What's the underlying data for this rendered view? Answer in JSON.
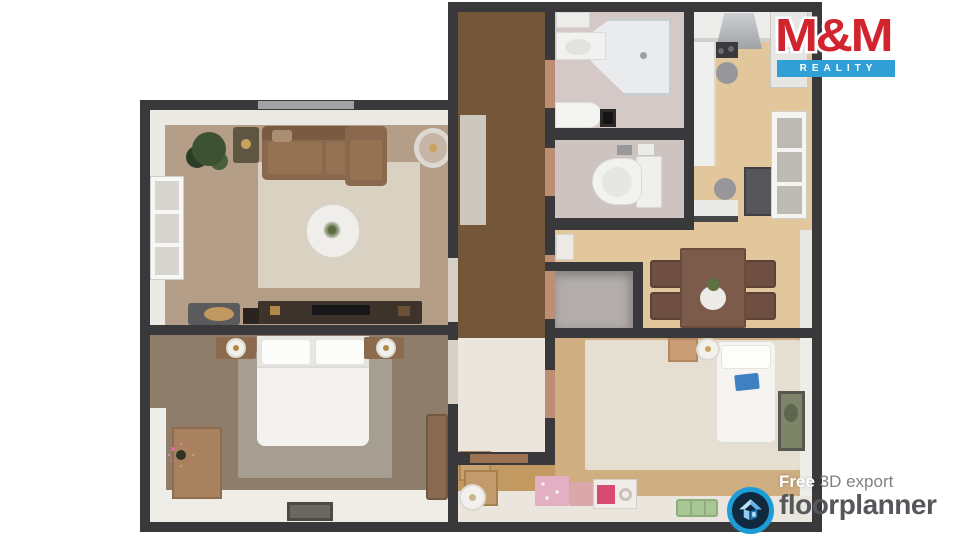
{
  "canvas": {
    "width": 960,
    "height": 540,
    "background": "#ffffff"
  },
  "branding": {
    "mm_reality": {
      "title": "M&M",
      "subtitle": "REALITY",
      "title_color": "#d2242e",
      "banner_color": "#2f9fd6",
      "subtitle_color": "#ffffff"
    }
  },
  "watermark": {
    "prefix_bold": "Free",
    "suffix": " 3D export",
    "brand": "floorplanner",
    "icon": "floorplanner-house-icon",
    "ring_color": "#1e9cd7",
    "badge_fill": "#10293e",
    "text_color": "#56575b"
  },
  "floorplan": {
    "type": "3d-top-down-apartment",
    "wall_color": "#39393b",
    "rooms": [
      {
        "name": "living-room",
        "floor_color": "#b59e87",
        "furniture": [
          "corner-sofa",
          "patterned-rug",
          "round-coffee-table",
          "tv-console",
          "potted-plant",
          "ceiling-fan",
          "side-table",
          "pet-bed",
          "left-window",
          "top-window"
        ]
      },
      {
        "name": "bedroom",
        "floor_color": "#8f7d6b",
        "furniture": [
          "double-bed",
          "nightstand-lamp-left",
          "nightstand-lamp-right",
          "gray-rug",
          "dresser-with-flowers",
          "storage-bench",
          "doormat"
        ]
      },
      {
        "name": "hallway",
        "floor_color": "#745639",
        "furniture": [
          "runner-rug"
        ]
      },
      {
        "name": "bathroom",
        "floor_color": "#d4c9c7",
        "furniture": [
          "corner-shower",
          "vanity-sink",
          "bathtub",
          "black-mat",
          "wall-shelf"
        ]
      },
      {
        "name": "wc",
        "floor_color": "#cdc3c0",
        "furniture": [
          "toilet"
        ]
      },
      {
        "name": "kitchen",
        "floor_color": "#e3c79c",
        "furniture": [
          "counter-run",
          "range-hood",
          "cooktop",
          "bar-stool",
          "bar-stool",
          "fridge-cabinet",
          "right-window",
          "tall-cabinet",
          "peninsula-counter"
        ]
      },
      {
        "name": "dining-area",
        "floor_color": "#e3c79c",
        "furniture": [
          "dining-table",
          "chair",
          "chair",
          "chair",
          "chair",
          "vase-with-plant",
          "small-cabinet"
        ]
      },
      {
        "name": "closet",
        "floor_color": "#b2adab",
        "furniture": []
      },
      {
        "name": "kids-room",
        "floor_color": "#cfae81",
        "furniture": [
          "single-bed",
          "cream-rug",
          "desk",
          "round-stool",
          "wall-art",
          "pink-toy-box",
          "pink-toy-box",
          "toy-package",
          "green-toy-bench",
          "paper-roll",
          "cardboard-boxes"
        ]
      }
    ]
  }
}
